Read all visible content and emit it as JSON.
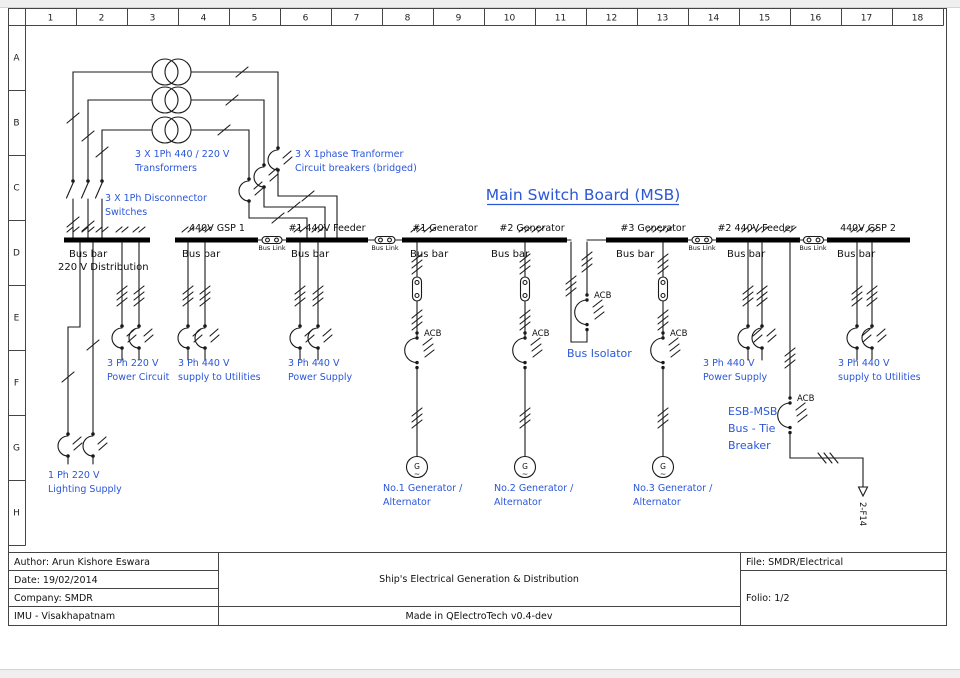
{
  "colors": {
    "annotation_blue": "#2b57d8",
    "wire_black": "#1a1a1a"
  },
  "grid": {
    "columns": [
      "1",
      "2",
      "3",
      "4",
      "5",
      "6",
      "7",
      "8",
      "9",
      "10",
      "11",
      "12",
      "13",
      "14",
      "15",
      "16",
      "17",
      "18"
    ],
    "rows": [
      "A",
      "B",
      "C",
      "D",
      "E",
      "F",
      "G",
      "H"
    ]
  },
  "main_title": "Main Switch Board (MSB)",
  "bus_labels": {
    "gsp1": "440V GSP 1",
    "feeder1": "#1 440V Feeder",
    "gen1": "#1 Generator",
    "gen2": "#2 Generator",
    "gen3": "#3 Generator",
    "feeder2": "#2 440V Feeder",
    "gsp2": "440V GSP 2",
    "bus_bar": "Bus bar",
    "bus_link": "Bus Link",
    "dist220": "220 V Distribution"
  },
  "device_labels": {
    "acb": "ACB",
    "feeder_ref": "2-F14",
    "generator_letter": "G",
    "generator_wave": "~"
  },
  "annotations": {
    "transformers": [
      "3 X 1Ph 440 / 220 V",
      "Transformers"
    ],
    "breakers_bridged": [
      "3 X 1phase Tranformer",
      "Circuit breakers (bridged)"
    ],
    "disconnectors": [
      "3 X 1Ph Disconnector",
      "Switches"
    ],
    "lighting": [
      "1 Ph 220 V",
      "Lighting Supply"
    ],
    "power220": [
      "3 Ph 220 V",
      "Power Circuit"
    ],
    "utilities1": [
      "3 Ph 440 V",
      "supply to Utilities"
    ],
    "power440_1": [
      "3 Ph 440 V",
      "Power Supply"
    ],
    "power440_2": [
      "3 Ph 440 V",
      "Power Supply"
    ],
    "utilities2": [
      "3 Ph 440 V",
      "supply to Utilities"
    ],
    "gen1": [
      "No.1 Generator /",
      "Alternator"
    ],
    "gen2": [
      "No.2 Generator /",
      "Alternator"
    ],
    "gen3": [
      "No.3 Generator /",
      "Alternator"
    ],
    "bus_isolator": "Bus Isolator",
    "bus_tie": [
      "ESB-MSB",
      "Bus - Tie",
      "Breaker"
    ]
  },
  "title_block": {
    "author": "Author: Arun Kishore Eswara",
    "date": "Date: 19/02/2014",
    "company": "Company: SMDR",
    "institute": "IMU - Visakhapatnam",
    "drawing_title": "Ship's Electrical Generation & Distribution",
    "made_in": "Made in QElectroTech v0.4-dev",
    "file": "File: SMDR/Electrical",
    "folio": "Folio: 1/2"
  }
}
